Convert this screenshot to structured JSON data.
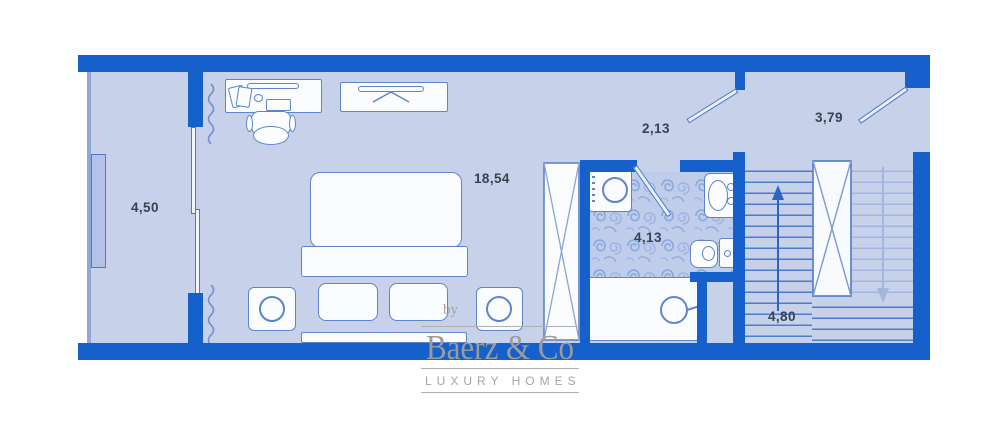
{
  "plan": {
    "rooms": {
      "balcony": {
        "area": "4,50"
      },
      "bedroom": {
        "area": "18,54"
      },
      "hallway": {
        "area": "2,13"
      },
      "landing": {
        "area": "3,79"
      },
      "bathroom": {
        "area": "4,13"
      },
      "staircase": {
        "area": "4,80"
      }
    },
    "colors": {
      "wall": "#1560ca",
      "floor": "#c8d1ea",
      "fixture_outline": "#5e84c9",
      "fixture_fill": "#fbfcfe",
      "bathroom_pattern_line": "#8aa8dc",
      "stair_step": "#4d7cc9",
      "stair_step_light": "#a3b6e0",
      "label_text": "#3a4150",
      "watermark_gray": "#9b9b9b"
    }
  },
  "watermark": {
    "prefix": "by",
    "brand": "Baerz & Co",
    "tagline": "LUXURY HOMES"
  }
}
